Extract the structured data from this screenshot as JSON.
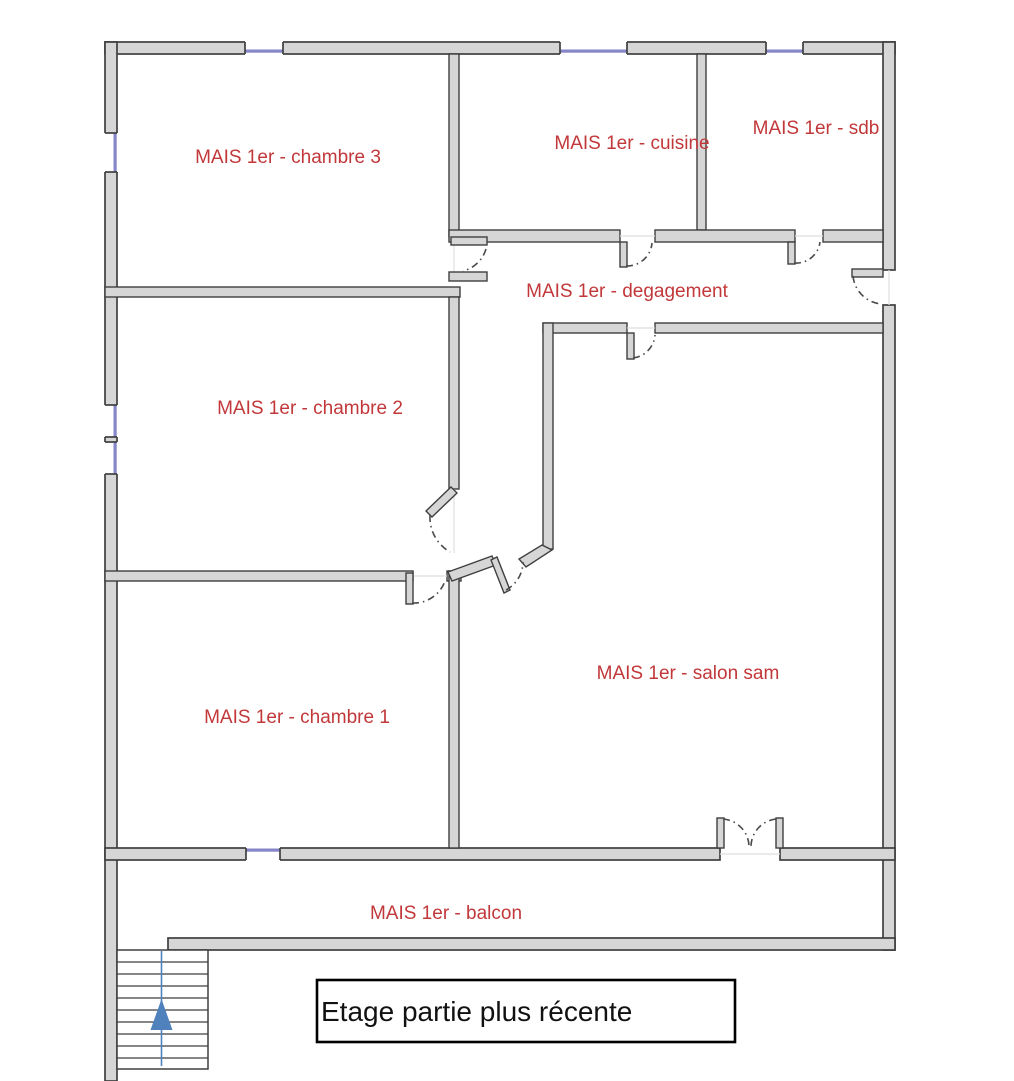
{
  "plan": {
    "rooms": [
      {
        "name": "chambre-3",
        "label": "MAIS 1er - chambre 3"
      },
      {
        "name": "cuisine",
        "label": "MAIS 1er - cuisine"
      },
      {
        "name": "sdb",
        "label": "MAIS 1er - sdb"
      },
      {
        "name": "degagement",
        "label": "MAIS 1er - degagement"
      },
      {
        "name": "chambre-2",
        "label": "MAIS 1er - chambre 2"
      },
      {
        "name": "chambre-1",
        "label": "MAIS 1er - chambre 1"
      },
      {
        "name": "salon-sam",
        "label": "MAIS 1er - salon sam"
      },
      {
        "name": "balcon",
        "label": "MAIS 1er - balcon"
      }
    ],
    "annotation": {
      "text": "Etage partie plus récente"
    },
    "stairs": {
      "direction_arrow": "up"
    },
    "colors": {
      "room_label": "#c2383a",
      "wall_fill": "#d6d6d6",
      "wall_stroke": "#3f3f3f",
      "window": "#8585c9",
      "stairs_arrow": "#4f81bd",
      "annotation_text": "#000000"
    }
  }
}
